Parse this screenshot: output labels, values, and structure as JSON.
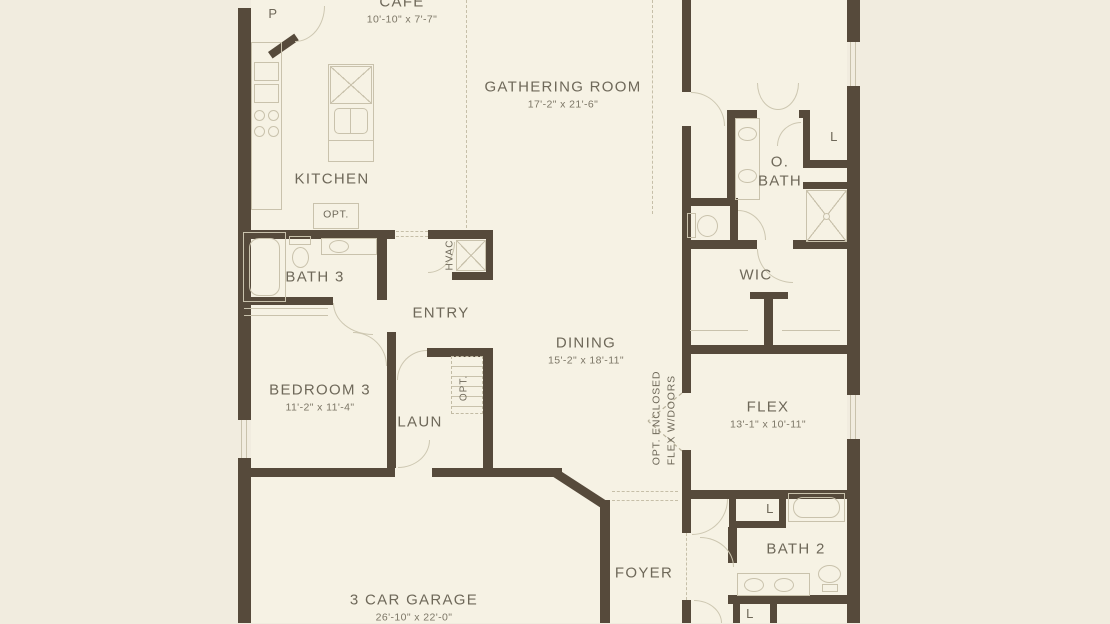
{
  "plan": {
    "rooms": {
      "pantry": {
        "name": "P"
      },
      "cafe": {
        "name": "CAFE",
        "dims": "10'-10\" x 7'-7\""
      },
      "gathering": {
        "name": "GATHERING ROOM",
        "dims": "17'-2\" x 21'-6\""
      },
      "kitchen": {
        "name": "KITCHEN"
      },
      "kitchen_opt": {
        "name": "OPT."
      },
      "bath3": {
        "name": "BATH 3"
      },
      "entry": {
        "name": "ENTRY"
      },
      "hvac": {
        "name": "HVAC"
      },
      "bedroom3": {
        "name": "BEDROOM 3",
        "dims": "11'-2\" x 11'-4\""
      },
      "laundry": {
        "name": "LAUN"
      },
      "laundry_opt": {
        "name": "OPT."
      },
      "dining": {
        "name": "DINING",
        "dims": "15'-2\" x 18'-11\""
      },
      "owners_bath": {
        "name_line1": "O.",
        "name_line2": "BATH"
      },
      "linen_obath": {
        "name": "L"
      },
      "wic": {
        "name": "WIC"
      },
      "flex": {
        "name": "FLEX",
        "dims": "13'-1\" x 10'-11\"",
        "note_line1": "OPT. ENCLOSED",
        "note_line2": "FLEX W/DOORS"
      },
      "foyer": {
        "name": "FOYER"
      },
      "bath2": {
        "name": "BATH 2"
      },
      "linen_bath2": {
        "name": "L"
      },
      "linen_hall": {
        "name": "L"
      },
      "garage": {
        "name": "3 CAR GARAGE",
        "dims": "26'-10\" x 22'-0\""
      }
    },
    "colors": {
      "background": "#f1ecdf",
      "floor": "#f6f2e4",
      "wall": "#564a3b",
      "fixture_line": "#c9c2ac",
      "text": "#6e6859"
    }
  }
}
